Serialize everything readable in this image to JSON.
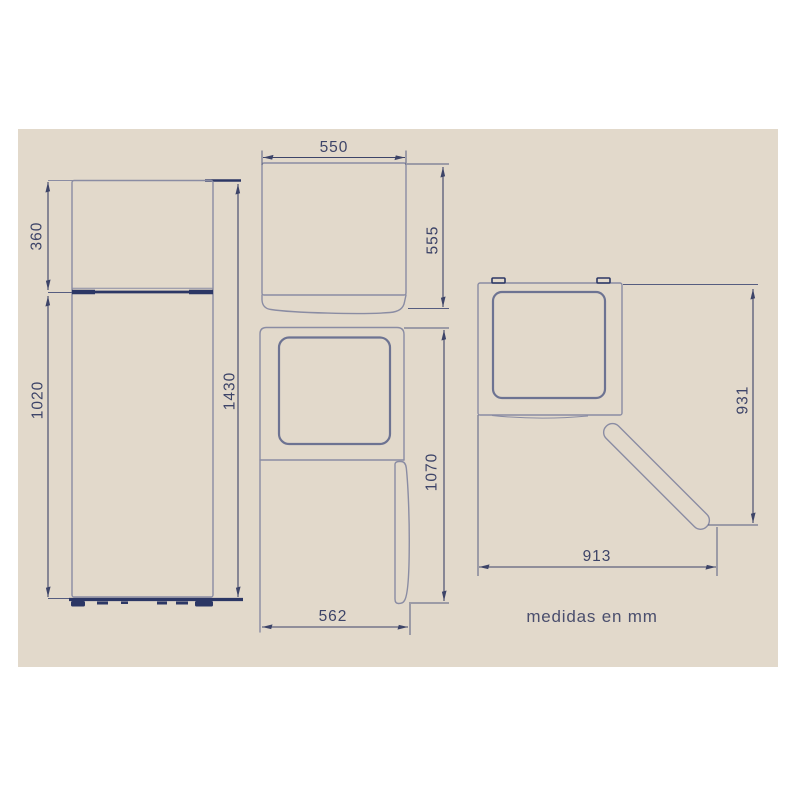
{
  "note": "medidas en mm",
  "dimensions": {
    "front_view": {
      "freezer_height_mm": "360",
      "fridge_height_mm": "1020",
      "total_height_mm": "1430"
    },
    "top_view": {
      "width_mm": "550",
      "depth_mm": "555"
    },
    "side_view": {
      "height_mm": "1070",
      "depth_mm": "562"
    },
    "door_open_view": {
      "depth_door_open_mm": "931",
      "width_door_open_mm": "913"
    }
  },
  "colors": {
    "page_background": "#ffffff",
    "panel_background": "#e2d9cb",
    "outline": "#8a8ca3",
    "inner_panel_line": "#6d7392",
    "dimension_line": "#3d4468",
    "accent_dark": "#2c3765",
    "label_text": "#3d4468",
    "note_text": "#4a4e6d"
  }
}
